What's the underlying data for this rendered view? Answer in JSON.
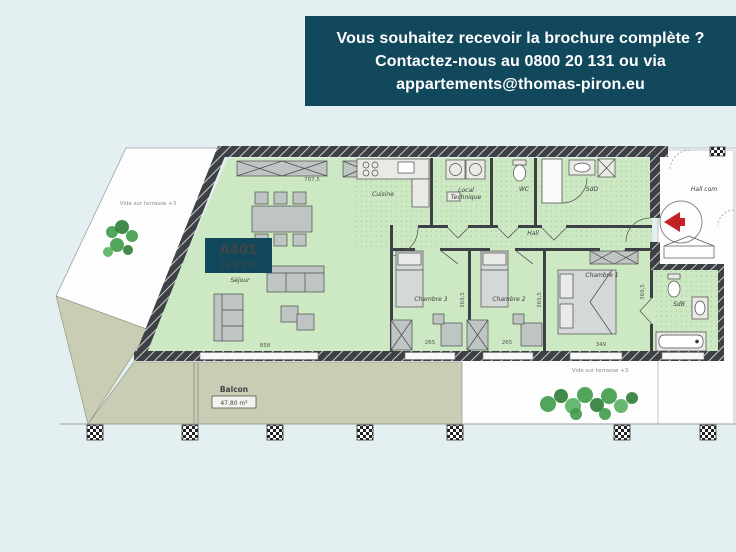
{
  "banner": {
    "line1": "Vous souhaitez recevoir la brochure complète ?",
    "line2": "Contactez-nous au 0800 20 131 ou via",
    "line3": "appartements@thomas-piron.eu",
    "bg_color": "#12485c",
    "text_color": "#ffffff"
  },
  "apartment": {
    "unit_label": "A401",
    "area_label": "129 m²"
  },
  "rooms": {
    "sejour": "Séjour",
    "cuisine": "Cuisine",
    "local_technique_line1": "Local",
    "local_technique_line2": "Technique",
    "wc": "WC",
    "sdd": "SdD",
    "hall": "Hall",
    "hall_commun": "Hall com",
    "chambre1": "Chambre 1",
    "chambre2": "Chambre 2",
    "chambre3": "Chambre 3",
    "sdb": "SdB",
    "balcon": "Balcon",
    "balcon_area": "47.80 m²",
    "vide_terrasse_left": "Vide sur terrasse +3",
    "vide_terrasse_right": "Vide sur terrasse +3"
  },
  "dimensions": {
    "top_width": "707,5",
    "left_height": "670,5",
    "sejour_width": "858",
    "chambre3_width": "265",
    "chambre2_width": "265",
    "chambre1_width": "349",
    "chambre3_depth": "369,5",
    "chambre2_depth": "369,5",
    "chambre1_depth": "369,5"
  },
  "colors": {
    "accent_teal": "#12485c",
    "room_green": "#cde9c4",
    "terrace_green_gray": "#c8cdb4",
    "wall_dark": "#3d4145",
    "entrance_arrow_red": "#c42127",
    "plant_green": "#3f9b49",
    "page_background": "#e3eff1"
  }
}
